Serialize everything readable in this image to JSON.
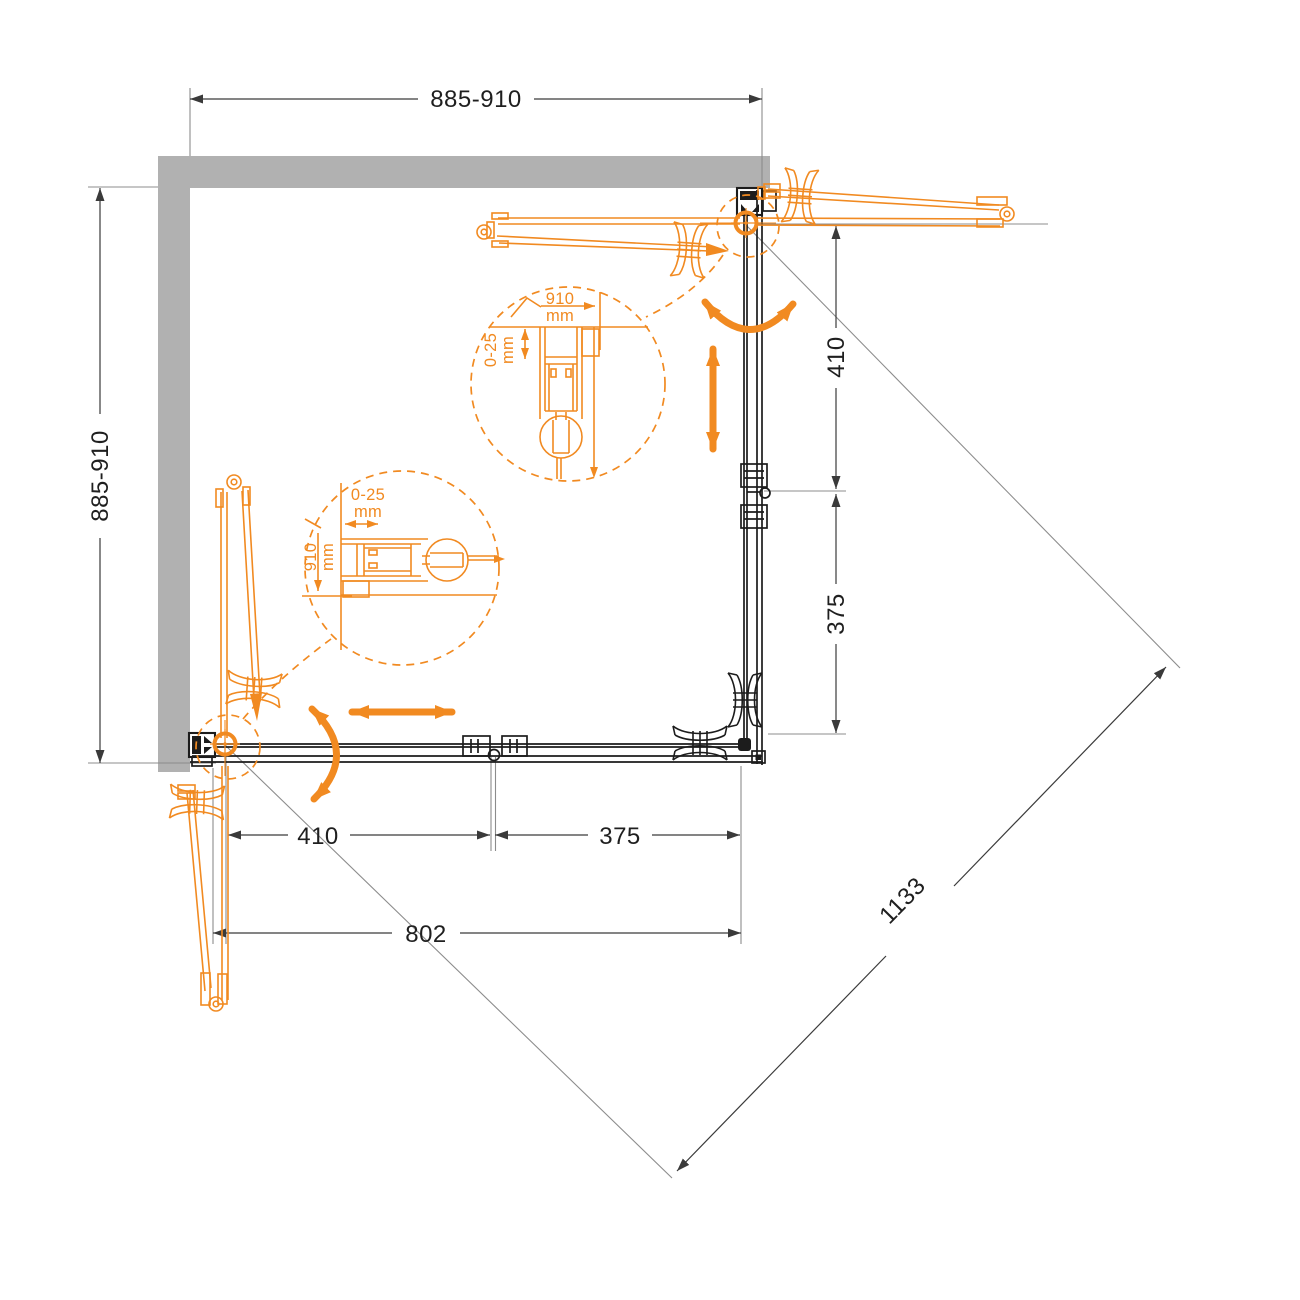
{
  "drawing": {
    "type": "technical-installation-diagram",
    "subject": "corner shower enclosure with bi-fold doors, top view"
  },
  "colors": {
    "accent_orange": "#F18A21",
    "wall_gray": "#B1B1B1",
    "line_dark": "#1C1C1C",
    "line_gray": "#8C8C8C",
    "line_dim": "#3A3A3A",
    "text_dark": "#1F1F1F"
  },
  "dims": {
    "top_width": "885-910",
    "left_depth": "885-910",
    "right_door": "410",
    "right_fixed": "375",
    "bottom_door": "410",
    "bottom_fixed": "375",
    "bottom_opening": "802",
    "diagonal_entry": "1133"
  },
  "detail_top": {
    "width": "910",
    "width_unit": "mm",
    "adjust": "0-25",
    "adjust_unit": "mm"
  },
  "detail_left": {
    "adjust": "0-25",
    "adjust_unit": "mm",
    "width": "910",
    "width_unit": "mm"
  }
}
